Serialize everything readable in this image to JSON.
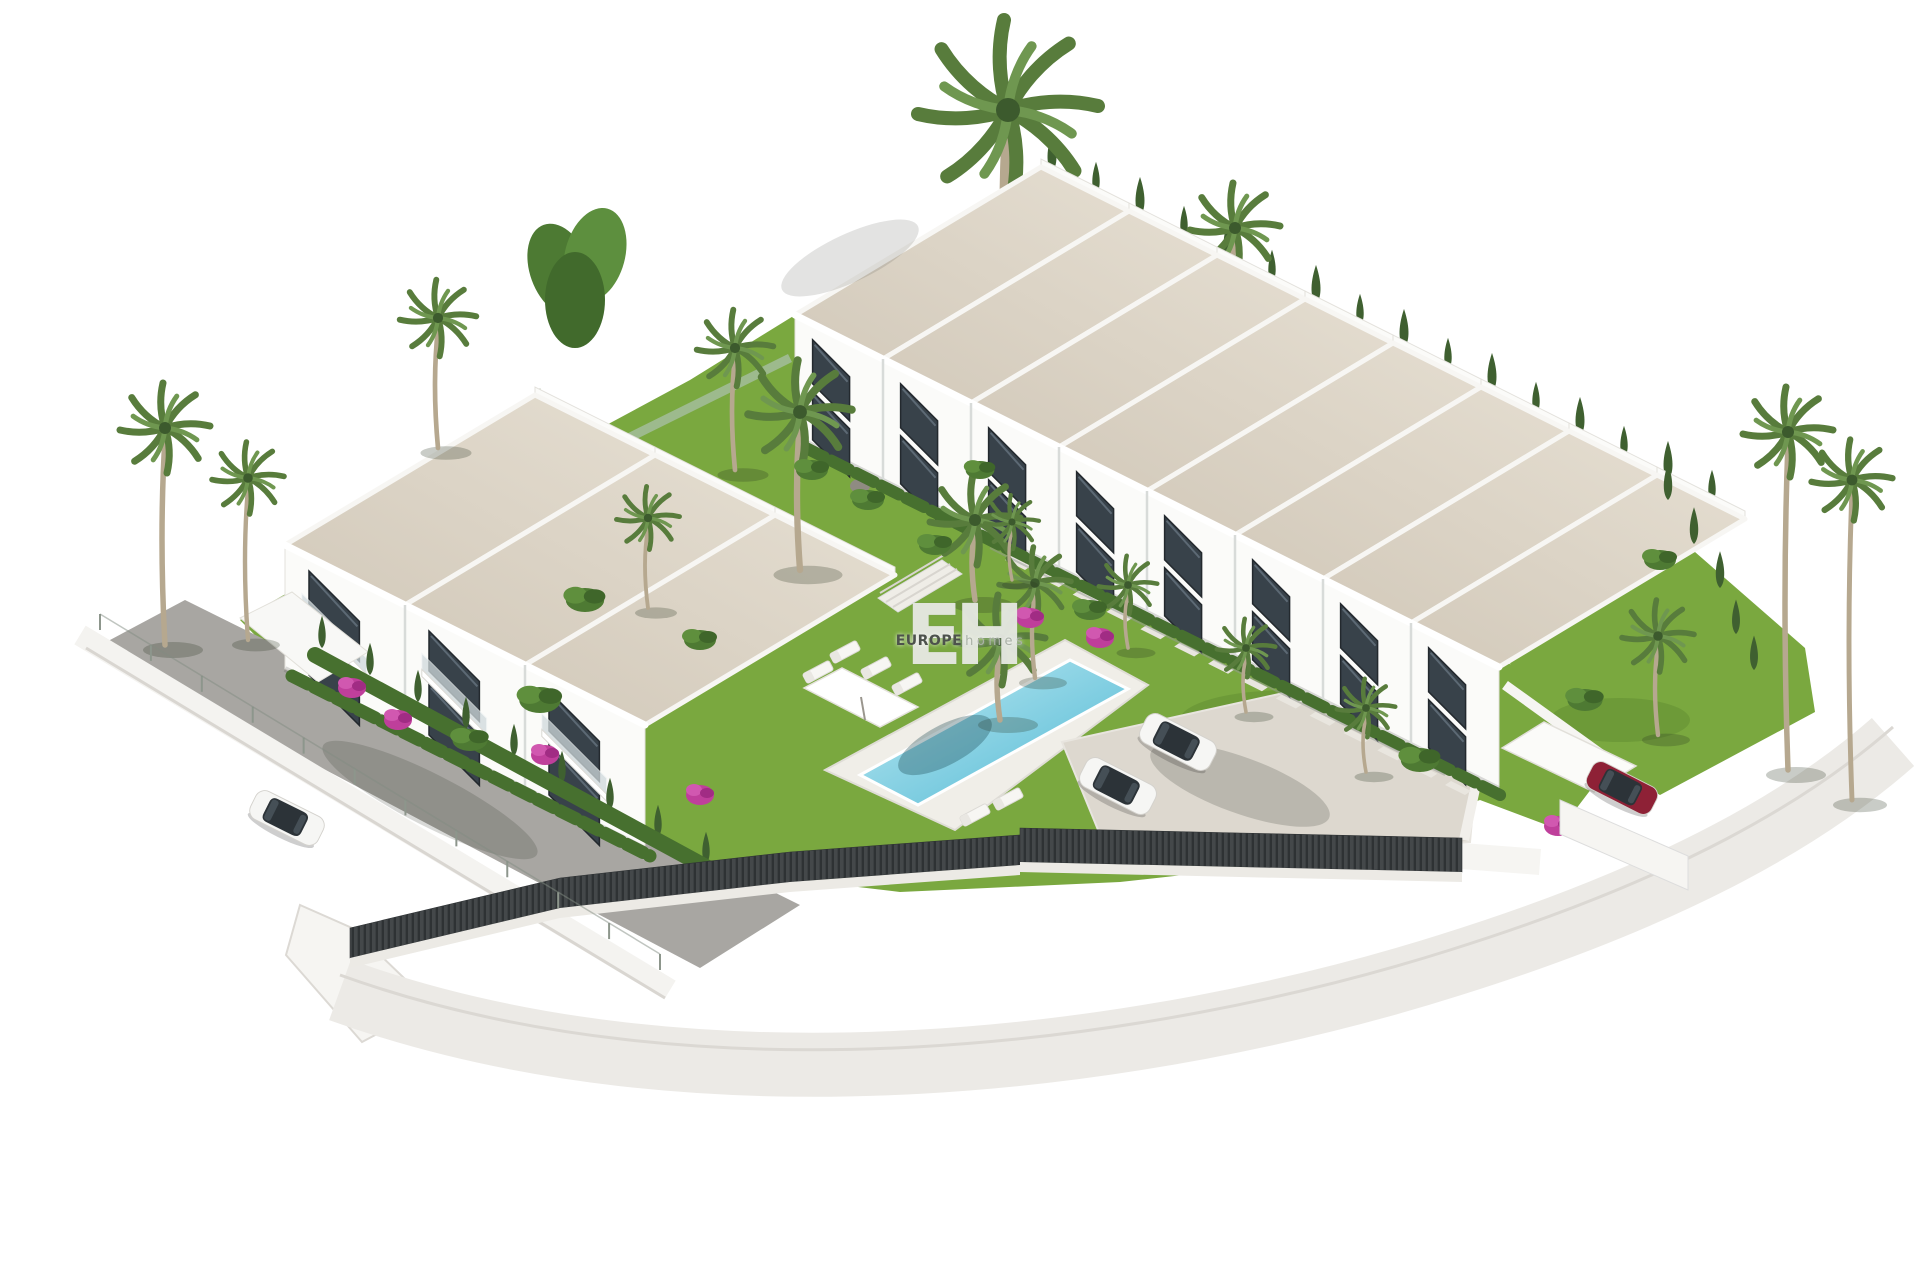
{
  "image": {
    "kind": "3D architectural render",
    "subject": "Aerial view of a white townhouse development with gardens, two pools, palm trees, a parking court and perimeter roads",
    "background": "#ffffff"
  },
  "watermark": {
    "monogram": "EH",
    "brand": "EUROPE",
    "brand_suffix": "homes"
  },
  "colors": {
    "bg": "#ffffff",
    "lawn": "#7aa83f",
    "lawn-dark": "#5d8a31",
    "roof": "#d3cabb",
    "roof-light": "#e4ddd0",
    "wall-white": "#fbfbf9",
    "window": "#38424a",
    "window-light": "#5c6974",
    "pool": "#4fb8d4",
    "pool-light": "#bfeaf2",
    "kids-pool": "#9fd9e8",
    "cypress": "#3f6030",
    "palm": "#587c3c",
    "palm-light": "#6f9750",
    "trunk": "#b6a88f",
    "bougainvillea": "#bf3f9b",
    "asphalt": "#a8a6a2",
    "paving": "#ddd8cf",
    "fence": "#44484a",
    "car-red": "#8e2136",
    "mono": "#e7e9e3",
    "brand": "#4d524c",
    "brand-suffix": "#aab1a7"
  },
  "scene": {
    "right_row": {
      "label": "stepped row of townhouses",
      "units": 8
    },
    "left_block": {
      "label": "two-storey townhouse block",
      "units": 3
    },
    "pools": {
      "main": "lap pool with sun loungers and parasol",
      "kids": "children's pool with swing set"
    },
    "parking": {
      "label": "parking court",
      "white_cars": 2
    },
    "street": {
      "label": "access road",
      "white_cars": 1
    },
    "carport": {
      "label": "carport",
      "red_cars": 1
    }
  }
}
